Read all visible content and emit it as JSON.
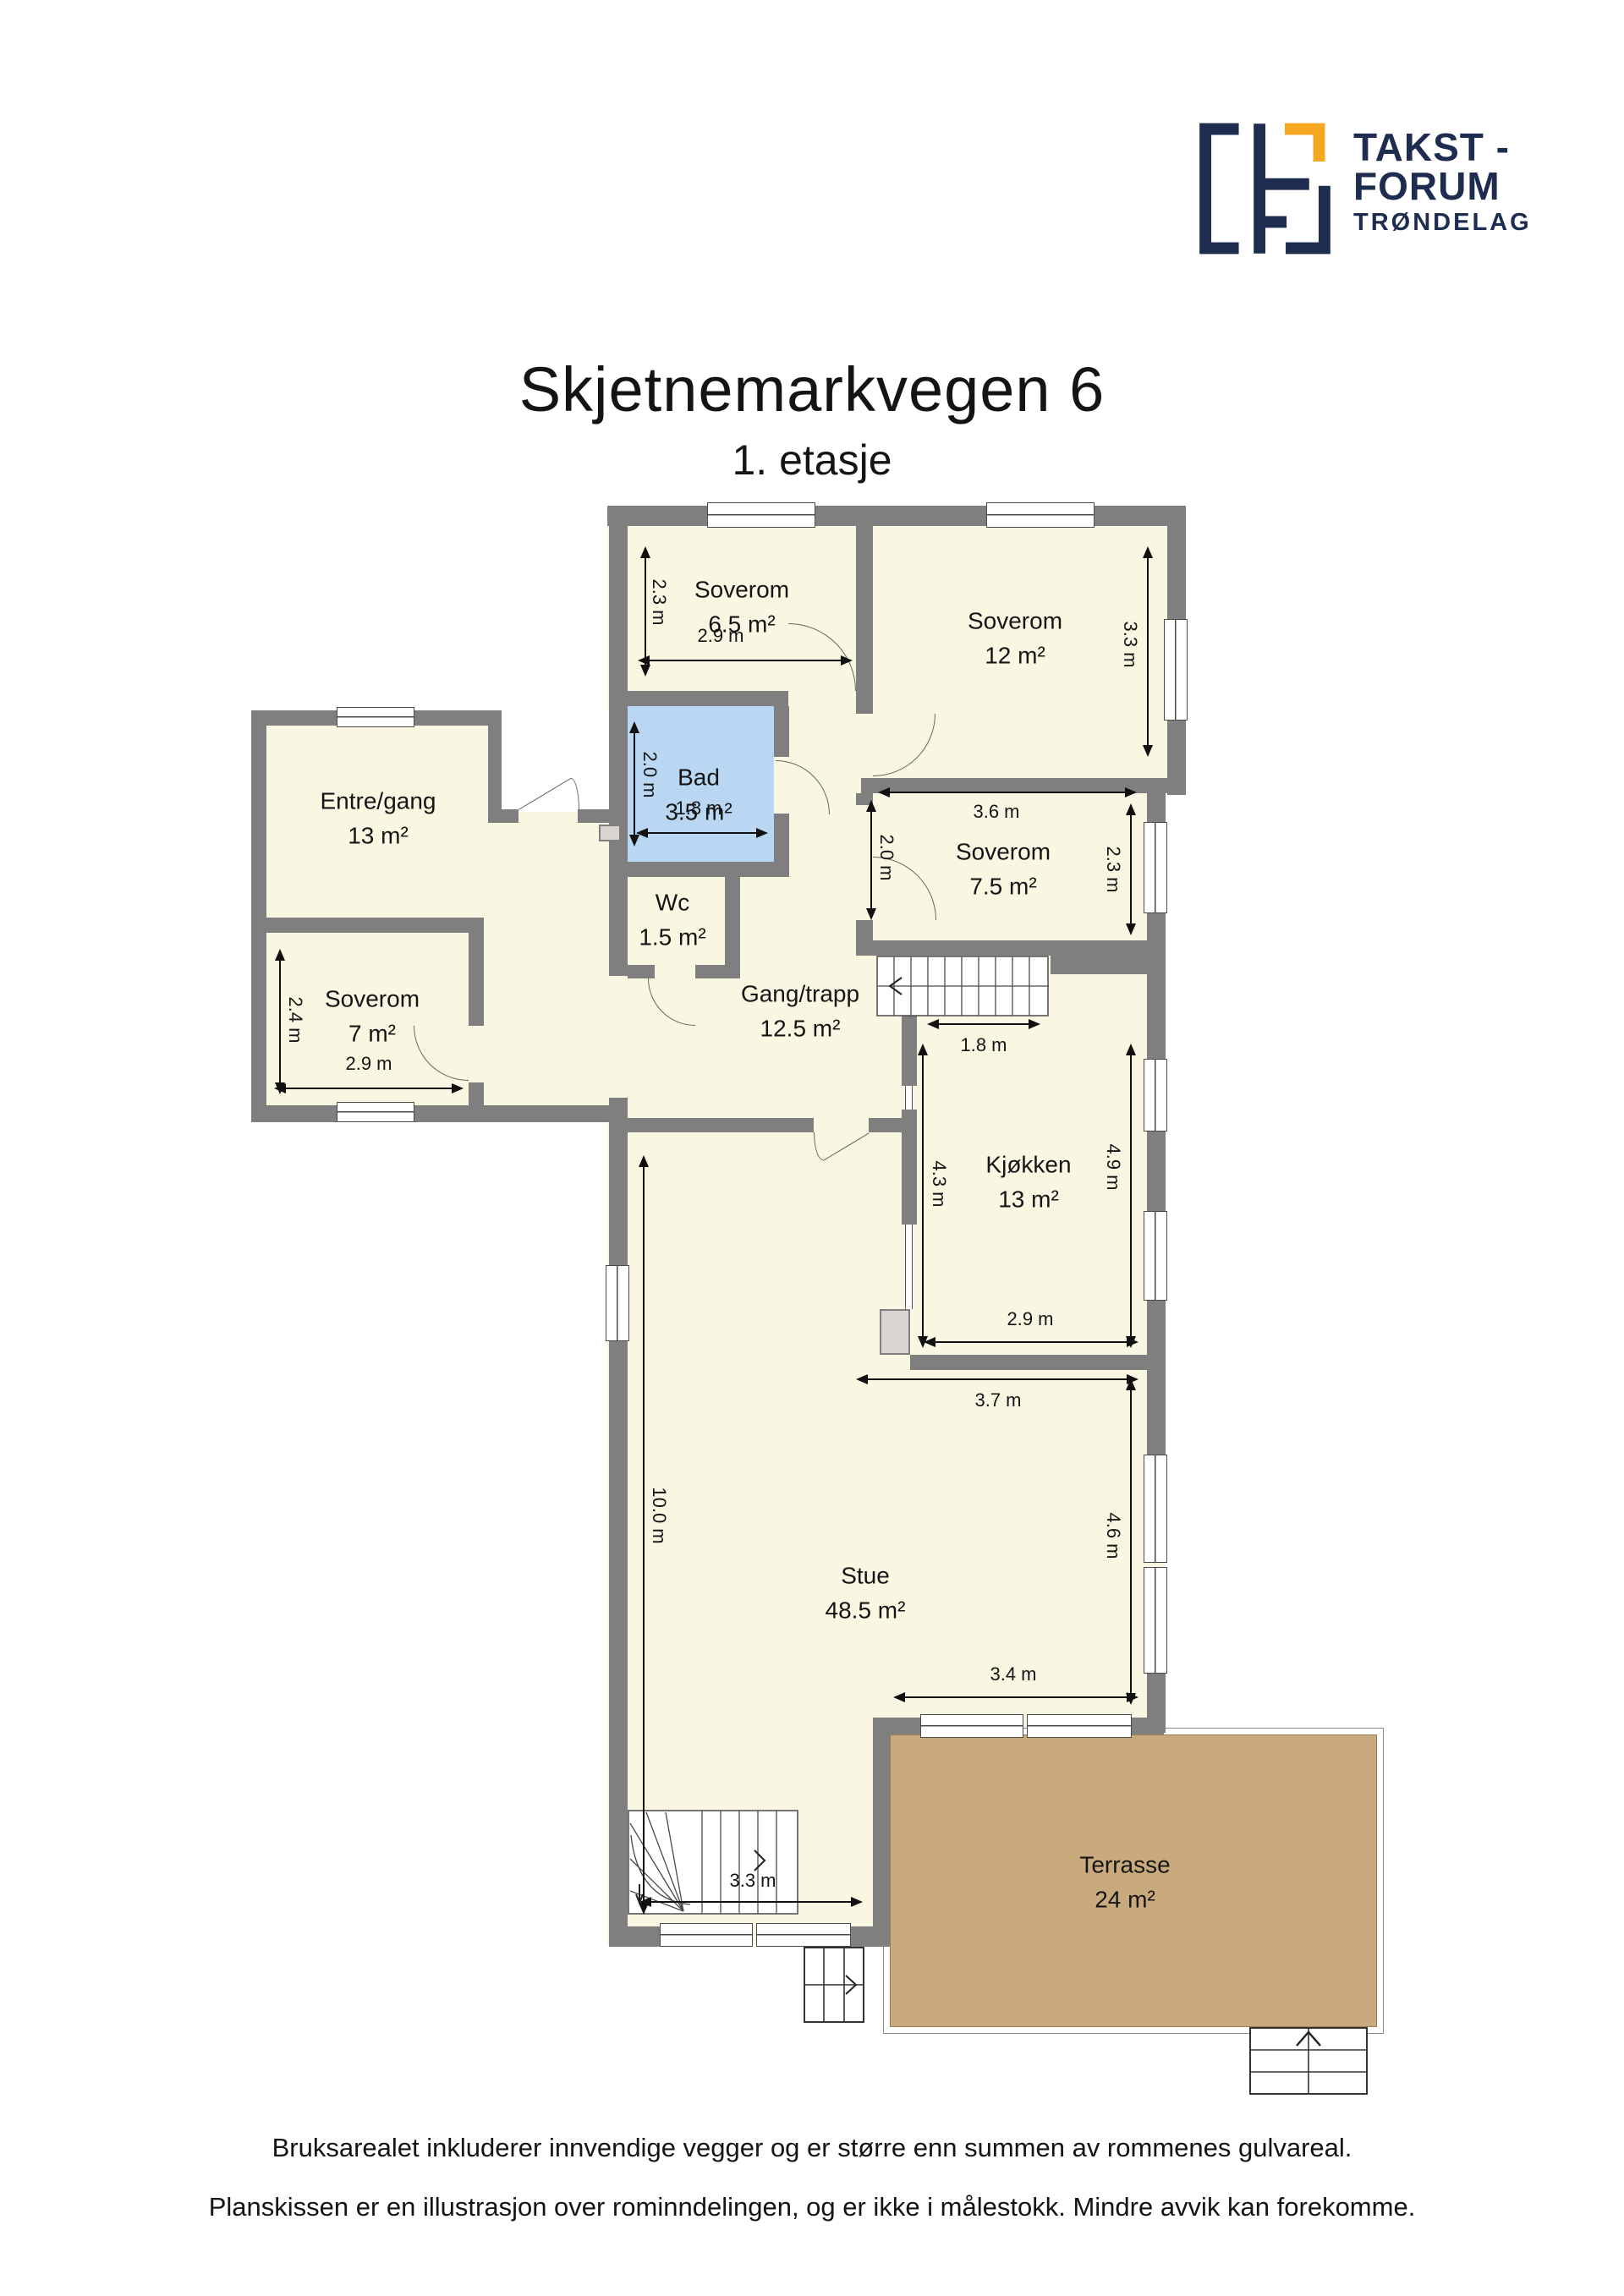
{
  "header": {
    "title": "Skjetnemarkvegen 6",
    "subtitle": "1. etasje"
  },
  "logo": {
    "line1": "TAKST -",
    "line2": "FORUM",
    "line3": "TRØNDELAG"
  },
  "rooms": {
    "soverom65": {
      "name": "Soverom",
      "area": "6.5 m²"
    },
    "soverom12": {
      "name": "Soverom",
      "area": "12 m²"
    },
    "entre": {
      "name": "Entre/gang",
      "area": "13 m²"
    },
    "bad": {
      "name": "Bad",
      "area": "3.5 m²"
    },
    "wc": {
      "name": "Wc",
      "area": "1.5 m²"
    },
    "soverom75": {
      "name": "Soverom",
      "area": "7.5 m²"
    },
    "soverom7": {
      "name": "Soverom",
      "area": "7 m²"
    },
    "gang": {
      "name": "Gang/trapp",
      "area": "12.5 m²"
    },
    "kjokken": {
      "name": "Kjøkken",
      "area": "13 m²"
    },
    "stue": {
      "name": "Stue",
      "area": "48.5 m²"
    },
    "terrasse": {
      "name": "Terrasse",
      "area": "24 m²"
    }
  },
  "dimensions": {
    "s65_h": "2.3 m",
    "s65_w": "2.9 m",
    "s12_h": "3.3 m",
    "bad_h": "2.0 m",
    "bad_w": "1.8 m",
    "s75_w": "3.6 m",
    "s75_h": "2.3 m",
    "s75_door": "2.0 m",
    "stair_opening": "1.8 m",
    "kjokken_left": "4.3 m",
    "kjokken_right": "4.9 m",
    "kjokken_w": "2.9 m",
    "stue_top_w": "3.7 m",
    "stue_h": "10.0 m",
    "stue_right_h": "4.6 m",
    "stue_bottom_w": "3.4 m",
    "stair_w": "3.3 m",
    "s7_h": "2.4 m",
    "s7_w": "2.9 m"
  },
  "footer": {
    "line1": "Bruksarealet inkluderer innvendige vegger og er større enn summen av rommenes gulvareal.",
    "line2": "Planskissen er en illustrasjon over rominndelingen, og er ikke i målestokk. Mindre avvik kan forekomme."
  },
  "colors": {
    "wall": "#7f7f7f",
    "floor": "#f9f6e2",
    "bathroom": "#b9d7f2",
    "terrace": "#c9aa7c",
    "logo_navy": "#1e2c50",
    "logo_orange": "#f5a81f"
  }
}
